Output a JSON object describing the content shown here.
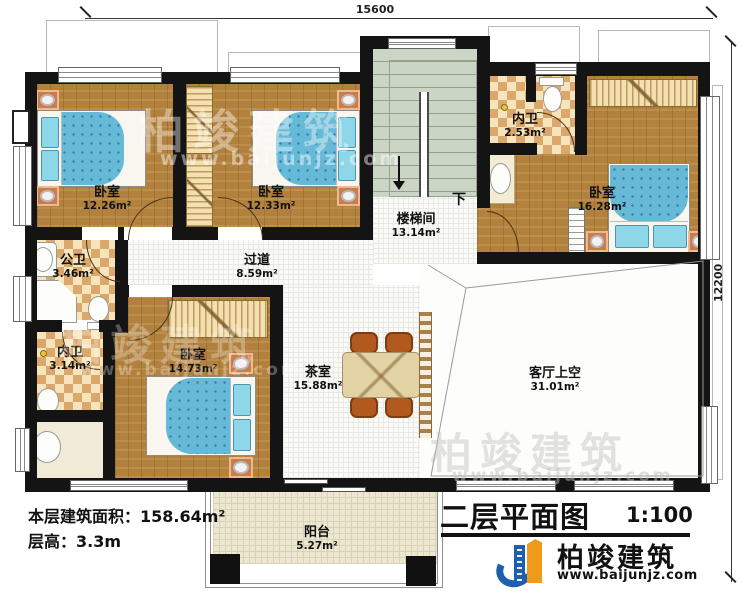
{
  "meta": {
    "title": "二层平面图",
    "scale": "1:100",
    "dim_width": "15600",
    "dim_height": "12200",
    "down_label": "下",
    "area_note_label": "本层建筑面积：",
    "area_note_value": "158.64m²",
    "height_note_label": "层高：",
    "height_note_value": "3.3m"
  },
  "logo": {
    "name": "柏竣建筑",
    "url": "www.baijunjz.com"
  },
  "watermark": {
    "text": "柏竣建筑",
    "url": "www.baijunjz.com"
  },
  "rooms": [
    {
      "id": "bedroom-1",
      "name": "卧室",
      "area": "12.26m²"
    },
    {
      "id": "bedroom-2",
      "name": "卧室",
      "area": "12.33m²"
    },
    {
      "id": "bedroom-3",
      "name": "卧室",
      "area": "14.73m²"
    },
    {
      "id": "bedroom-master",
      "name": "卧室",
      "area": "16.28m²"
    },
    {
      "id": "stairwell",
      "name": "楼梯间",
      "area": "13.14m²"
    },
    {
      "id": "corridor",
      "name": "过道",
      "area": "8.59m²"
    },
    {
      "id": "public-bath",
      "name": "公卫",
      "area": "3.46m²"
    },
    {
      "id": "ensuite-bath-top",
      "name": "内卫",
      "area": "2.53m²"
    },
    {
      "id": "ensuite-bath-left",
      "name": "内卫",
      "area": "3.14m²"
    },
    {
      "id": "tea-room",
      "name": "茶室",
      "area": "15.88m²"
    },
    {
      "id": "living-void",
      "name": "客厅上空",
      "area": "31.01m²"
    },
    {
      "id": "balcony",
      "name": "阳台",
      "area": "5.27m²"
    }
  ]
}
